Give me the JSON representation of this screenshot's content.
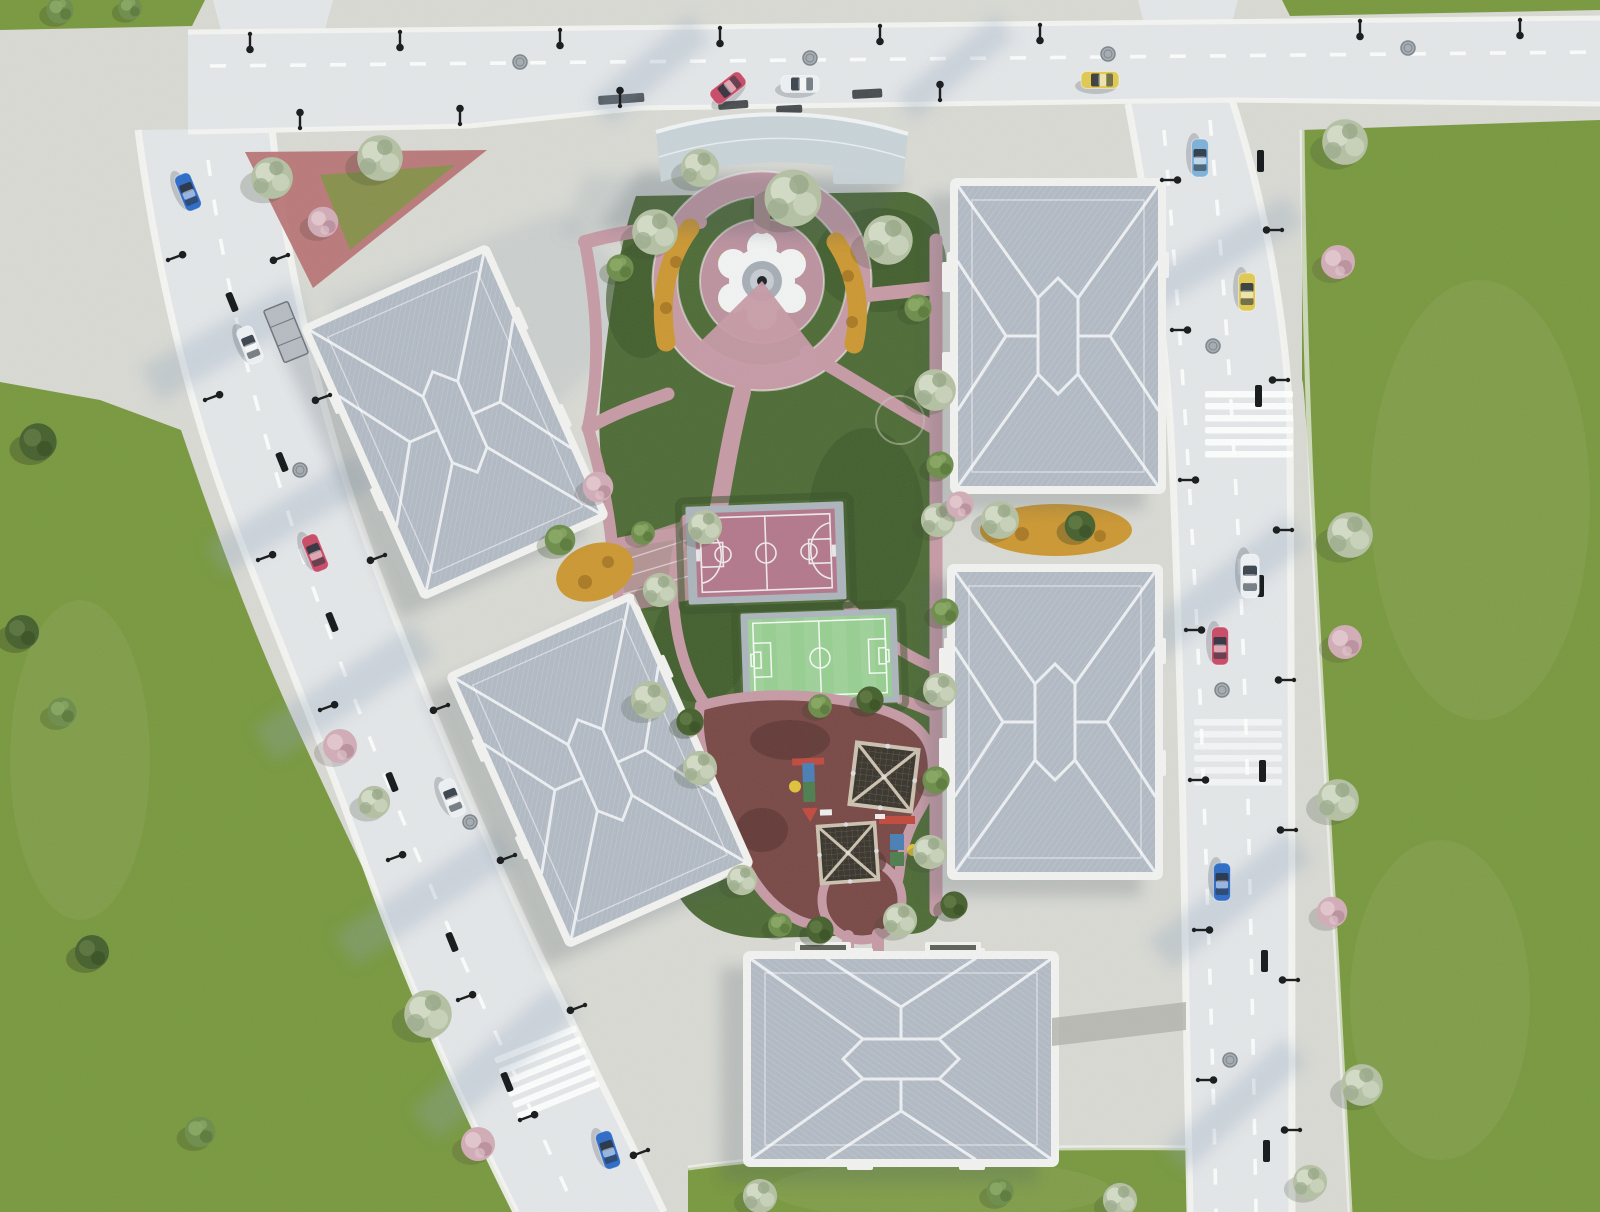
{
  "meta": {
    "title": "Aerial site plan rendering of a residential complex",
    "view": "top-down architectural visualization",
    "no_visible_text": true
  },
  "palette": {
    "pavement": "#d9dad4",
    "road": "#e4e7e9",
    "curb": "#f6f7f4",
    "grass": "#79993f",
    "grass_light": "#93ad62",
    "court_green": "#4f6c37",
    "court_green_dark": "#3f5a2b",
    "hedge": "#3a5429",
    "pink": "#c69ba6",
    "plaza_pink": "#bd93a0",
    "tri_red": "#b66f70",
    "orange": "#cc9833",
    "orange_dark": "#95671d",
    "court_pink": "#b3798c",
    "court_frame": "#adb5bd",
    "court_line": "#f3eff1",
    "field": "#98cf92",
    "pg": "#794947",
    "pg_dark": "#5c3835",
    "net_frame": "#cdc2b1",
    "net_dark": "#3a362e",
    "roof": "#b2bac4",
    "ridge": "#f3f5f7",
    "bld_white": "#f2f3f0",
    "canopy": "#c9d4d8",
    "shadow": "#4e5b68",
    "road_shadow": "#8ba3ba",
    "glass": "#28323d",
    "lamp": "#17191a",
    "manhole": "#a6adb2",
    "car_blue": "#2f6cc7",
    "car_red": "#c94b67",
    "car_white": "#edf1f3",
    "car_yellow": "#e1ca52",
    "car_sky": "#7eb1d9"
  },
  "scene": {
    "buildings": [
      {
        "id": "block-a",
        "shape": "rotated residential block, hip roof",
        "position": "upper-left of site"
      },
      {
        "id": "block-b",
        "shape": "rotated residential block, hip roof",
        "position": "mid-left of site"
      },
      {
        "id": "block-c",
        "shape": "residential block, hip roof",
        "position": "upper-right of site"
      },
      {
        "id": "block-d",
        "shape": "residential block, hip roof",
        "position": "mid-right of site"
      },
      {
        "id": "block-e",
        "shape": "residential block, hip roof",
        "position": "bottom of site"
      },
      {
        "id": "entrance-canopy",
        "shape": "curved canopy at north entrance",
        "position": "top-center"
      }
    ],
    "amenities": [
      {
        "id": "fountain-plaza",
        "desc": "circular pink plaza with white gear-shaped fountain and ring path"
      },
      {
        "id": "basketball-court",
        "desc": "pink basketball court with white markings"
      },
      {
        "id": "football-field",
        "desc": "green mini football field with white markings"
      },
      {
        "id": "playground",
        "desc": "maroon rubber playground with two net-climber pyramids and play structures"
      },
      {
        "id": "flower-beds",
        "desc": "orange flower beds near fountain and between blocks"
      },
      {
        "id": "triangle-plaza",
        "desc": "red triangular pocket plaza with trees at north-west corner"
      }
    ],
    "roads": [
      {
        "id": "top-road",
        "orientation": "horizontal along top edge"
      },
      {
        "id": "left-road",
        "orientation": "diagonal along left side"
      },
      {
        "id": "right-road",
        "orientation": "vertical along right side"
      }
    ],
    "vehicles": [
      {
        "road": "top-road",
        "color": "white"
      },
      {
        "road": "top-road",
        "color": "red"
      },
      {
        "road": "top-road",
        "color": "yellow"
      },
      {
        "road": "right-road",
        "color": "sky-blue"
      },
      {
        "road": "right-road",
        "color": "yellow"
      },
      {
        "road": "right-road",
        "color": "white"
      },
      {
        "road": "right-road",
        "color": "red"
      },
      {
        "road": "right-road",
        "color": "blue"
      },
      {
        "road": "left-road",
        "color": "blue"
      },
      {
        "road": "left-road",
        "color": "white"
      },
      {
        "road": "left-road",
        "color": "red"
      },
      {
        "road": "left-road",
        "color": "white"
      },
      {
        "road": "left-road",
        "color": "blue"
      }
    ],
    "vegetation": {
      "lawns": 4,
      "tree_types": [
        "sage-green",
        "green",
        "dark-green",
        "pink-blossom"
      ],
      "approx_tree_count": 45
    },
    "street_furniture": [
      "street lamps",
      "manholes",
      "crosswalks",
      "bus shelter",
      "lane dashes"
    ]
  }
}
